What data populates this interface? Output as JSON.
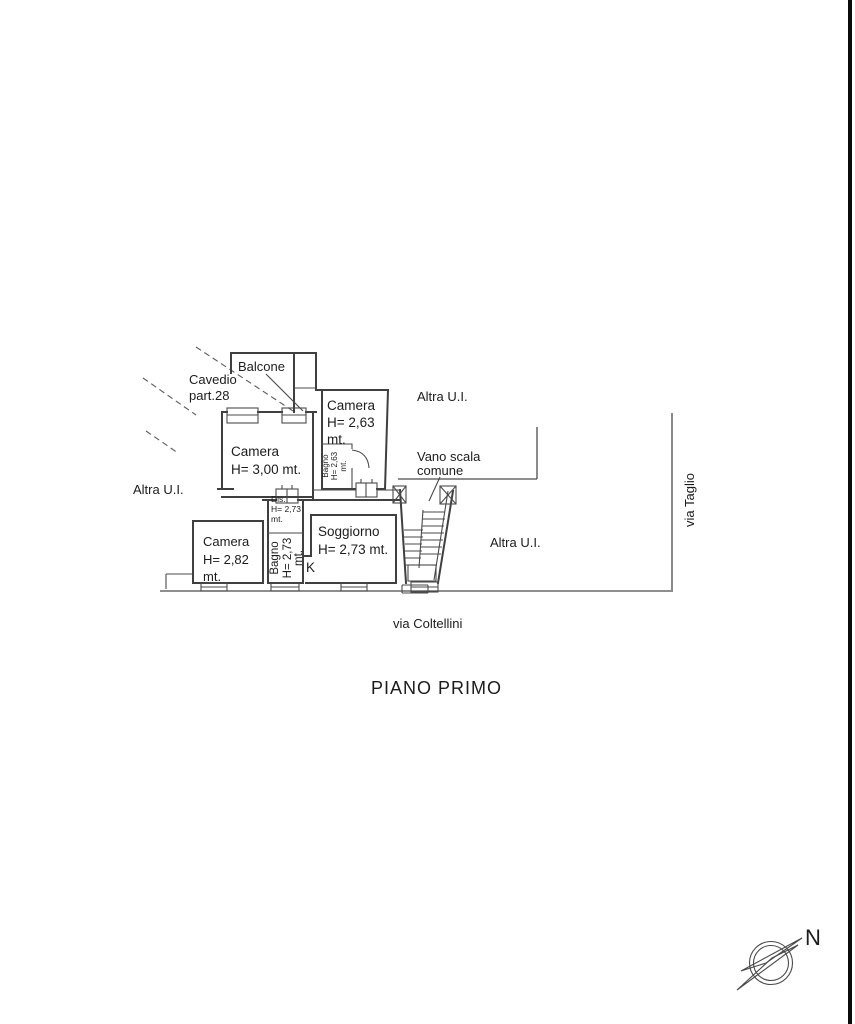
{
  "page": {
    "background": "#ffffff",
    "line_color": "#3f3f3f",
    "text_color": "#1c1c1c",
    "scan_border_color": "#0a0a0a"
  },
  "title": "PIANO PRIMO",
  "streets": {
    "bottom": "via Coltellini",
    "right": "via Taglio"
  },
  "compass": {
    "north_label": "N"
  },
  "neighbors": {
    "top": "Altra U.I.",
    "left": "Altra U.I.",
    "right": "Altra U.I."
  },
  "rooms": {
    "balcone": {
      "name": "Balcone"
    },
    "cavedio": {
      "line1": "Cavedio",
      "line2": "part.28"
    },
    "camera_263": {
      "name": "Camera",
      "height": "H= 2,63",
      "unit": "mt."
    },
    "camera_300": {
      "name": "Camera",
      "height": "H= 3,00 mt."
    },
    "camera_282": {
      "name": "Camera",
      "height": "H= 2,82",
      "unit": "mt."
    },
    "bagno_263": {
      "name": "Bagno",
      "height": "H= 2,63",
      "unit": "mt."
    },
    "bagno_273": {
      "name": "Bagno",
      "height": "H= 2,73",
      "unit": "mt."
    },
    "dis": {
      "name": "Dis.",
      "height": "H= 2,73",
      "unit": "mt."
    },
    "soggiorno": {
      "name": "Soggiorno",
      "height": "H= 2,73 mt."
    },
    "kitchen": {
      "label": "K"
    },
    "vano_scala": {
      "line1": "Vano scala",
      "line2": "comune"
    }
  }
}
